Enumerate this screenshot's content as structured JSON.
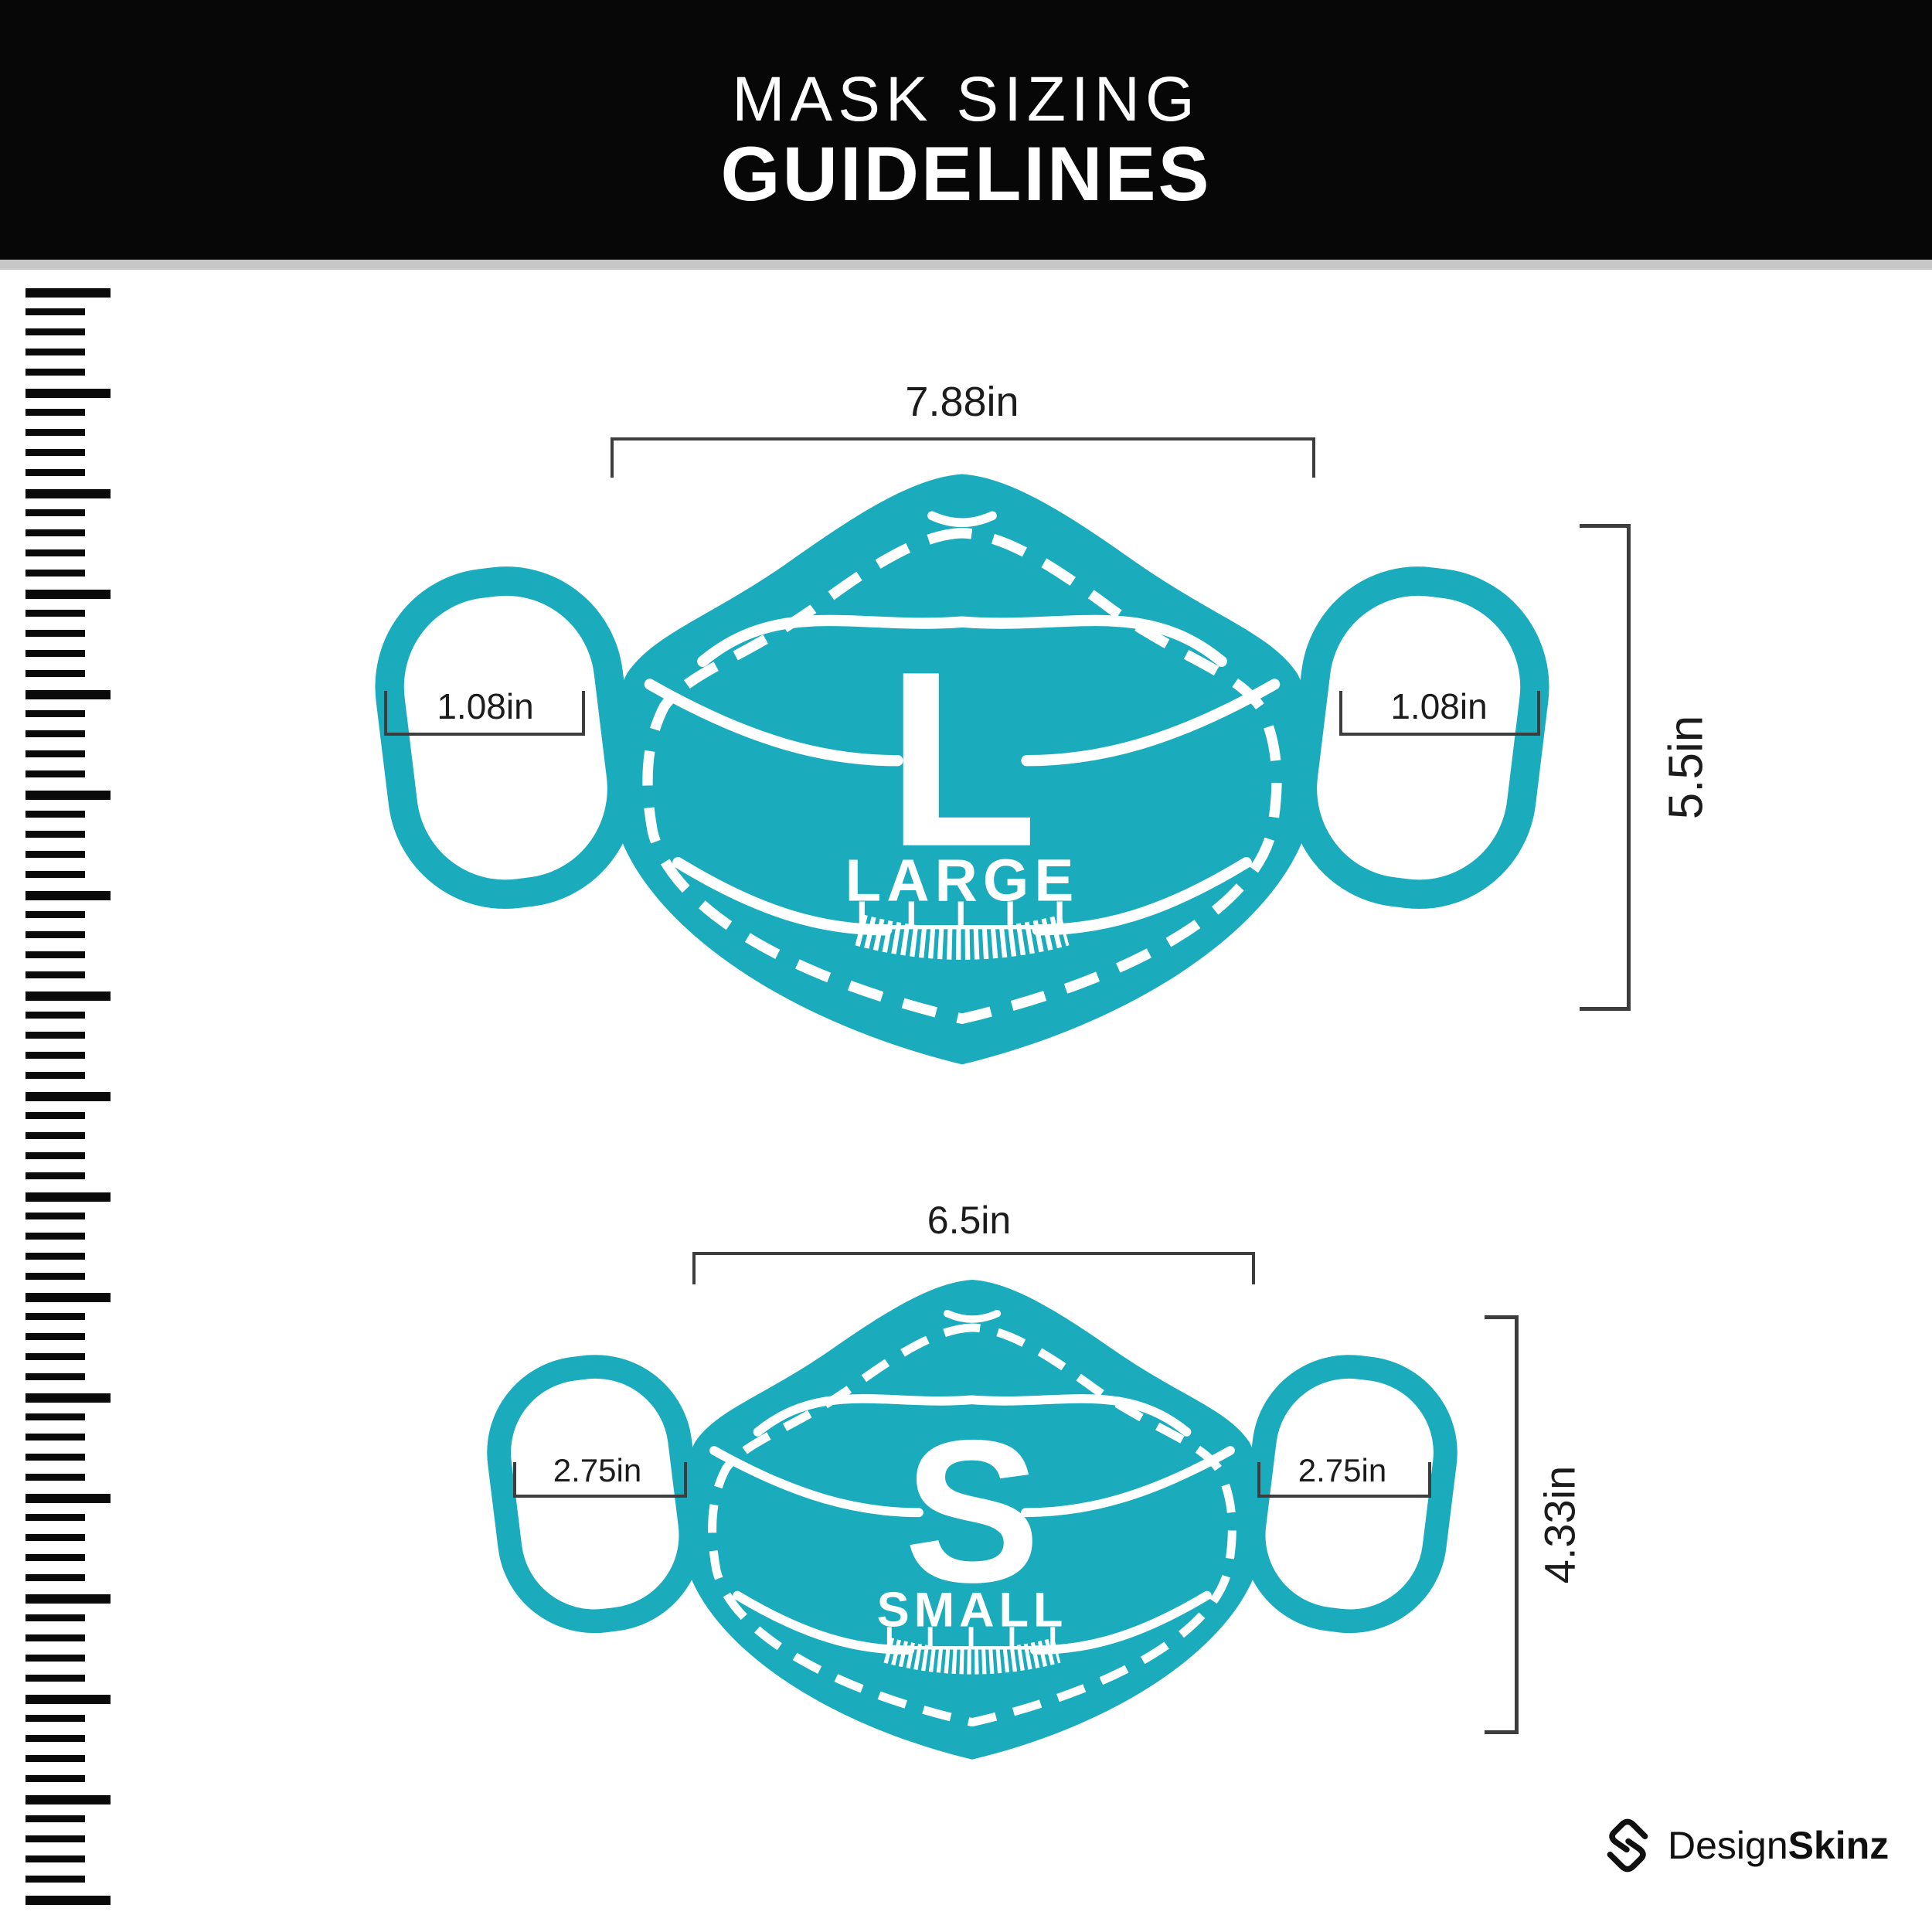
{
  "header": {
    "title_line1": "MASK SIZING",
    "title_line2": "GUIDELINES"
  },
  "masks": [
    {
      "size_letter": "L",
      "size_word": "LARGE",
      "width": "7.88in",
      "height": "5.5in",
      "ear_width": "1.08in"
    },
    {
      "size_letter": "S",
      "size_word": "SMALL",
      "width": "6.5in",
      "height": "4.33in",
      "ear_width": "2.75in"
    }
  ],
  "footer": {
    "brand_regular": "Design",
    "brand_bold": "Skinz"
  },
  "icons": {
    "left_sidebar": "ruler-ticks-icon",
    "mask_chin": "chin-ruler-fringe-icon",
    "brand": "designskinz-diamond-s-icon"
  },
  "colors": {
    "mask_teal": "#1AABBC",
    "header_black": "#070707",
    "divider_gray": "#c7c7c7",
    "dimension_line": "#3d3d3d",
    "text_dark": "#1c1c1c",
    "logo_black": "#101010"
  }
}
